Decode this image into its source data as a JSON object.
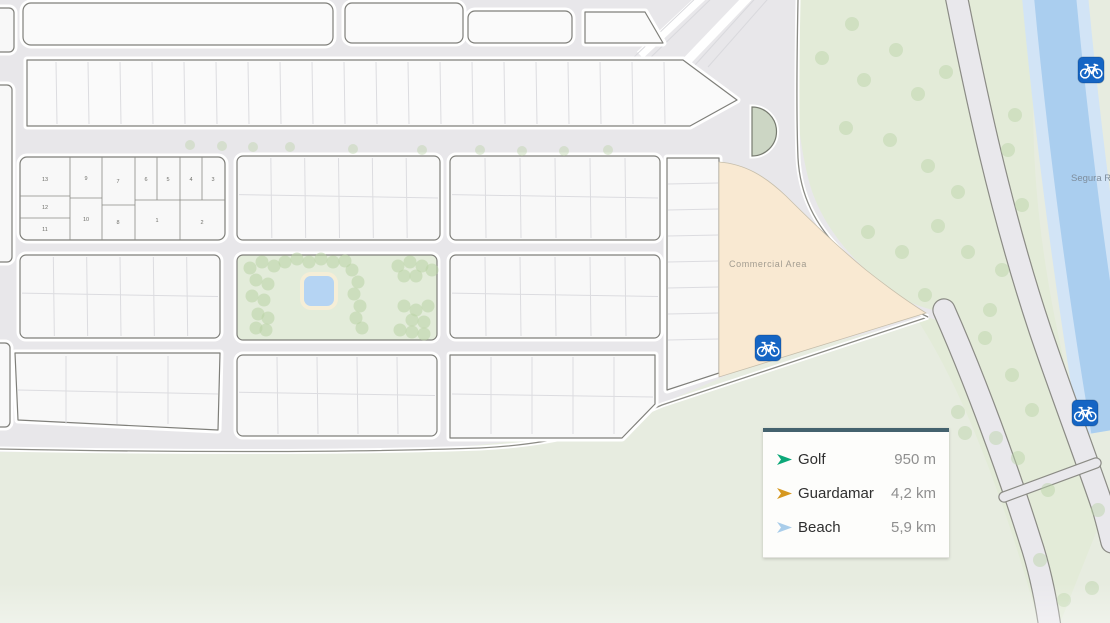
{
  "map": {
    "labels": {
      "commercial_area": "Commercial Area",
      "river": "Segura River"
    },
    "numbered_plots": [
      "13",
      "9",
      "7",
      "6",
      "5",
      "4",
      "3",
      "12",
      "10",
      "8",
      "11",
      "1",
      "2"
    ],
    "icons": {
      "bike_marker": "bicycle"
    },
    "colors": {
      "paved": "#e8e7ea",
      "road": "#e9e8ec",
      "road_edge": "#8b8b85",
      "block": "#f8f8f8",
      "block_bright": "#fafafa",
      "block_border": "#7f7f7a",
      "block_line": "#dcdce0",
      "plot_line": "#8b8b86",
      "casing": "#ffffff",
      "green": "#e7ece0",
      "green_right": "#e3ebd8",
      "park": "#e3ecda",
      "tree": "#b9d3a6",
      "river": "#aaceef",
      "river_edge": "#d2e4f6",
      "pond": "#b5d4f3",
      "pond_ring": "#f5eed7",
      "commercial": "#f9e9d2",
      "commercial_border": "#c6beab",
      "roundabout": "#ccd6c4",
      "roundabout_border": "#777b70",
      "bike": "#1565c4",
      "label_gray": "#a29c90",
      "river_label": "#7e8d9c",
      "legend_accent": "#44626e"
    }
  },
  "legend": {
    "items": [
      {
        "label": "Golf",
        "value": "950 m",
        "color": "#0ca878"
      },
      {
        "label": "Guardamar",
        "value": "4,2 km",
        "color": "#d6981f"
      },
      {
        "label": "Beach",
        "value": "5,9 km",
        "color": "#a9cdea"
      }
    ]
  }
}
